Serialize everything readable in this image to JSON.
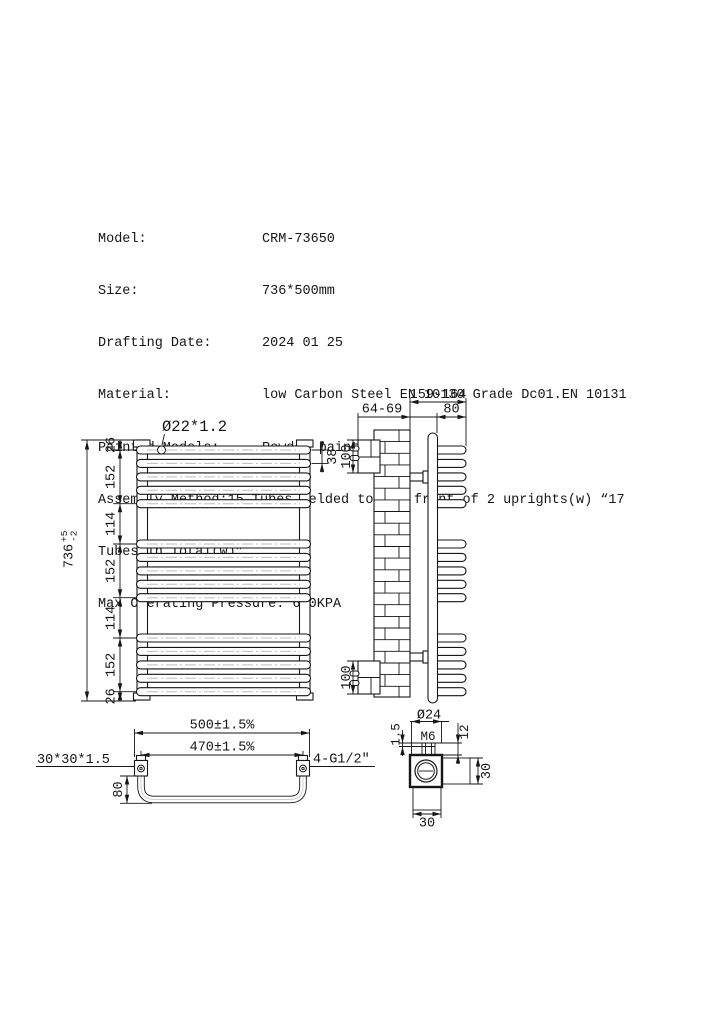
{
  "doc": {
    "rows": [
      {
        "label": "Model:",
        "value": "CRM-73650"
      },
      {
        "label": "Size:",
        "value": "736*500mm"
      },
      {
        "label": "Drafting Date:",
        "value": "2024 01 25"
      },
      {
        "label": "Material:",
        "value": "low Carbon Steel EN 10130 Grade Dc01.EN 10131"
      },
      {
        "label": "Painted Models:",
        "value": "Powder painted"
      }
    ],
    "assembly_line1": "Assembly Method:15 Tubes Welded to the front of 2 uprights(w) “17",
    "assembly_line2": "Tubes in Total(w)”",
    "pressure_line": "Max Operating Pressure: 600KPA"
  },
  "front_view": {
    "tube_label": "Ø22*1.2",
    "overall_height": "736",
    "tol_plus": "+5",
    "tol_minus": "-2",
    "chain_dims": [
      "26",
      "152",
      "114",
      "152",
      "114",
      "152",
      "26"
    ],
    "tube_pitch": "38"
  },
  "side_view": {
    "overall_depth": "159-164",
    "wall_clearance": "64-69",
    "tube_depth": "80",
    "bracket_height_top": "100",
    "bracket_height_bottom": "100"
  },
  "bottom_view": {
    "overall_width": "500±1.5%",
    "center_distance": "470±1.5%",
    "upright_tube": "30*30*1.5",
    "connections": "4-G1/2″",
    "depth": "80"
  },
  "detail_view": {
    "boss_dia": "Ø24",
    "thread": "M6",
    "boss_height": "12",
    "plate_thickness": "1.5",
    "width": "30",
    "height": "30"
  }
}
